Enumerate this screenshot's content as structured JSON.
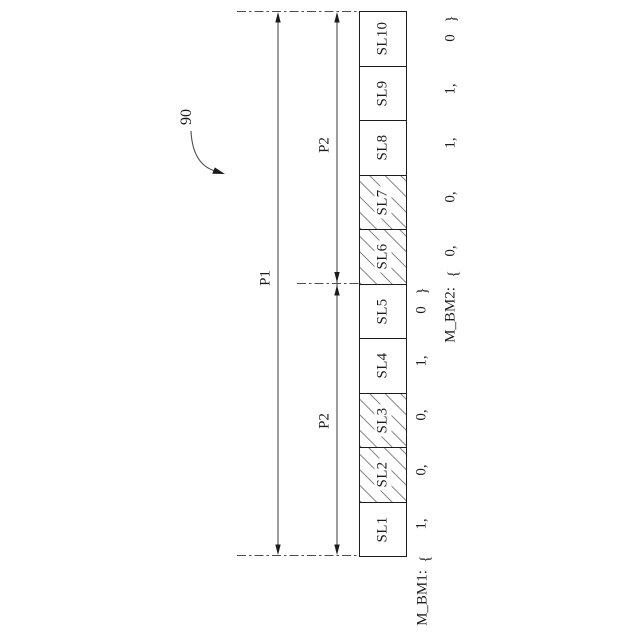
{
  "figure_reference": "90",
  "dimension_labels": {
    "p1": "P1",
    "p2_upper": "P2",
    "p2_lower": "P2"
  },
  "slots_top_to_bottom": [
    {
      "label": "SL10",
      "hatched": false
    },
    {
      "label": "SL9",
      "hatched": false
    },
    {
      "label": "SL8",
      "hatched": false
    },
    {
      "label": "SL7",
      "hatched": true
    },
    {
      "label": "SL6",
      "hatched": true
    },
    {
      "label": "SL5",
      "hatched": false
    },
    {
      "label": "SL4",
      "hatched": false
    },
    {
      "label": "SL3",
      "hatched": true
    },
    {
      "label": "SL2",
      "hatched": true
    },
    {
      "label": "SL1",
      "hatched": false
    }
  ],
  "bitmaps": {
    "bm1": {
      "label": "M_BM1:",
      "open": "{",
      "close": "}",
      "values_bottom_to_top": [
        "1,",
        "0,",
        "0,",
        "1,",
        "0"
      ]
    },
    "bm2": {
      "label": "M_BM2:",
      "open": "{",
      "close": "}",
      "values_bottom_to_top": [
        "0,",
        "0,",
        "1,",
        "1,",
        "0"
      ]
    }
  }
}
